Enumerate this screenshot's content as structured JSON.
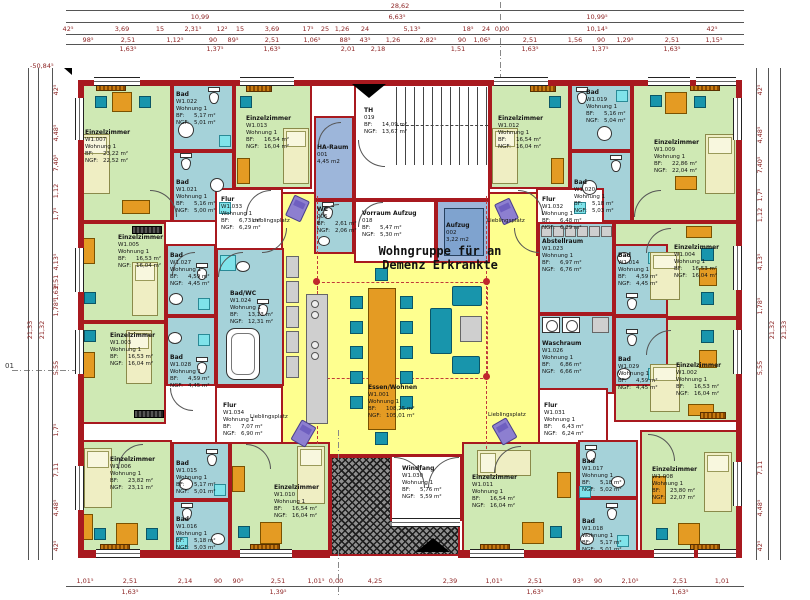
{
  "meta": {
    "title1": "Wohngruppe für an",
    "title2": "Demenz Erkrankte"
  },
  "labels": {
    "bf": "BF:",
    "ngf": "NGF:",
    "lieblingsplatz": "Lieblingsplatz"
  },
  "rooms": {
    "w1001": {
      "name": "Essen/Wohnen",
      "num": "W1.001",
      "apt": "Wohnung 1",
      "bf": "108,25 m²",
      "ngf": "105,01 m²"
    },
    "w1002": {
      "name": "Einzelzimmer",
      "num": "W1.002",
      "apt": "Wohnung 1",
      "bf": "16,53 m²",
      "ngf": "16,04 m²"
    },
    "w1003": {
      "name": "Einzelzimmer",
      "num": "W1.003",
      "apt": "Wohnung 1",
      "bf": "16,53 m²",
      "ngf": "16,04 m²"
    },
    "w1004": {
      "name": "Einzelzimmer",
      "num": "W1.004",
      "apt": "Wohnung 1",
      "bf": "16,53 m²",
      "ngf": "16,04 m²"
    },
    "w1005": {
      "name": "Einzelzimmer",
      "num": "W1.005",
      "apt": "Wohnung 1",
      "bf": "16,53 m²",
      "ngf": "16,04 m²"
    },
    "w1006": {
      "name": "Einzelzimmer",
      "num": "W1.006",
      "apt": "Wohnung 1",
      "bf": "23,82 m²",
      "ngf": "23,11 m²"
    },
    "w1007": {
      "name": "Einzelzimmer",
      "num": "W1.007",
      "apt": "Wohnung 1",
      "bf": "23,22 m²",
      "ngf": "22,52 m²"
    },
    "w1008": {
      "name": "Einzelzimmer",
      "num": "W1.008",
      "apt": "Wohnung 1",
      "bf": "23,80 m²",
      "ngf": "22,07 m²"
    },
    "w1009": {
      "name": "Einzelzimmer",
      "num": "W1.009",
      "apt": "Wohnung 1",
      "bf": "22,86 m²",
      "ngf": "22,04 m²"
    },
    "w1010": {
      "name": "Einzelzimmer",
      "num": "W1.010",
      "apt": "Wohnung 1",
      "bf": "16,54 m²",
      "ngf": "16,04 m²"
    },
    "w1011": {
      "name": "Einzelzimmer",
      "num": "W1.011",
      "apt": "Wohnung 1",
      "bf": "16,54 m²",
      "ngf": "16,04 m²"
    },
    "w1012": {
      "name": "Einzelzimmer",
      "num": "W1.012",
      "apt": "Wohnung 1",
      "bf": "16,54 m²",
      "ngf": "16,04 m²"
    },
    "w1013": {
      "name": "Einzelzimmer",
      "num": "W1.013",
      "apt": "Wohnung 1",
      "bf": "16,54 m²",
      "ngf": "16,04 m²"
    },
    "w1014": {
      "name": "Bad",
      "num": "W1.014",
      "apt": "Wohnung 1",
      "bf": "4,59 m²",
      "ngf": "4,45 m²"
    },
    "w1015": {
      "name": "Bad",
      "num": "W1.015",
      "apt": "Wohnung 1",
      "bf": "5,17 m²",
      "ngf": "5,01 m²"
    },
    "w1016": {
      "name": "Bad",
      "num": "W1.016",
      "apt": "Wohnung 1",
      "bf": "5,18 m²",
      "ngf": "5,03 m²"
    },
    "w1017": {
      "name": "Bad",
      "num": "W1.017",
      "apt": "Wohnung 1",
      "bf": "5,18 m²",
      "ngf": "5,02 m²"
    },
    "w1018": {
      "name": "Bad",
      "num": "W1.018",
      "apt": "Wohnung 1",
      "bf": "5,17 m²",
      "ngf": "5,01 m²"
    },
    "w1019": {
      "name": "Bad",
      "num": "W1.019",
      "apt": "Wohnung 1",
      "bf": "5,16 m²",
      "ngf": "5,04 m²"
    },
    "w1020": {
      "name": "Bad",
      "num": "W1.020",
      "apt": "Wohnung 1",
      "bf": "5,18 m²",
      "ngf": "5,03 m²"
    },
    "w1021": {
      "name": "Bad",
      "num": "W1.021",
      "apt": "Wohnung 1",
      "bf": "5,16 m²",
      "ngf": "5,00 m²"
    },
    "w1022": {
      "name": "Bad",
      "num": "W1.022",
      "apt": "Wohnung 1",
      "bf": "5,17 m²",
      "ngf": "5,01 m²"
    },
    "w1023": {
      "name": "Abstellraum",
      "num": "W1.023",
      "apt": "Wohnung 1",
      "bf": "6,97 m²",
      "ngf": "6,76 m²"
    },
    "w1024": {
      "name": "Bad/WC",
      "num": "W1.024",
      "apt": "Wohnung 1",
      "bf": "13,13 m²",
      "ngf": "12,31 m²"
    },
    "w1026": {
      "name": "Waschraum",
      "num": "W1.026",
      "apt": "Wohnung 1",
      "bf": "6,86 m²",
      "ngf": "6,66 m²"
    },
    "w1027": {
      "name": "Bad",
      "num": "W1.027",
      "apt": "Wohnung 1",
      "bf": "4,59 m²",
      "ngf": "4,45 m²"
    },
    "w1028": {
      "name": "Bad",
      "num": "W1.028",
      "apt": "Wohnung 1",
      "bf": "4,59 m²",
      "ngf": "4,45 m²"
    },
    "w1029": {
      "name": "Bad",
      "num": "W1.029",
      "apt": "Wohnung 1",
      "bf": "4,59 m²",
      "ngf": "4,45 m²"
    },
    "w1030": {
      "name": "Windfang",
      "num": "W1.030",
      "apt": "Wohnung 1",
      "bf": "5,76 m²",
      "ngf": "5,59 m²"
    },
    "w1031": {
      "name": "Flur",
      "num": "W1.031",
      "apt": "Wohnung 1",
      "bf": "6,43 m²",
      "ngf": "6,24 m²"
    },
    "w1032": {
      "name": "Flur",
      "num": "W1.032",
      "apt": "Wohnung 1",
      "bf": "6,48 m²",
      "ngf": "6,29 m²"
    },
    "w1033": {
      "name": "Flur",
      "num": "W1.033",
      "apt": "Wohnung 1",
      "bf": "6,73 m²",
      "ngf": "6,29 m²"
    },
    "w1034": {
      "name": "Flur",
      "num": "W1.034",
      "apt": "Wohnung 1",
      "bf": "7,07 m²",
      "ngf": "6,90 m²"
    },
    "ha": {
      "name": "HA-Raum",
      "num": "001",
      "area": "4,45 m2"
    },
    "aufzug": {
      "name": "Aufzug",
      "num": "002",
      "area": "3,22 m2"
    },
    "wc": {
      "name": "WC",
      "num": "006",
      "bf": "2,61 m²",
      "ngf": "2,06 m²"
    },
    "vorraum": {
      "name": "Vorraum Aufzug",
      "num": "018",
      "bf": "5,47 m²",
      "ngf": "5,30 m²"
    },
    "th": {
      "name": "TH",
      "num": "019",
      "bf": "14,09 m²",
      "ngf": "13,67 m²"
    }
  },
  "dims": {
    "total_top": "28,62",
    "top2": [
      "10,99",
      "6,63⁵",
      "10,99⁵"
    ],
    "top3": [
      "42⁵",
      "3,69",
      "15",
      "2,31⁵",
      "12²",
      "15",
      "3,69",
      "17⁵",
      "25",
      "1,26",
      "24",
      "5,13⁵",
      "18⁵",
      "24",
      "0,00",
      "10,14⁵",
      "42⁵"
    ],
    "top4": [
      "98⁵",
      "2,51",
      "1,12⁵",
      "90",
      "89⁵",
      "2,51",
      "1,06⁵",
      "88⁵",
      "43⁵",
      "1,26",
      "2,82⁵",
      "90",
      "1,06⁵",
      "2,51",
      "1,56",
      "90",
      "1,29⁵",
      "2,51",
      "1,15⁵"
    ],
    "top5": [
      "1,63⁵",
      "1,37⁵",
      "1,63⁵",
      "2,01",
      "2,18",
      "1,51",
      "1,63⁵",
      "1,37⁵",
      "1,63⁵"
    ],
    "bottom1": [
      "1,01⁵",
      "2,51",
      "2,14",
      "90",
      "90⁵",
      "2,51",
      "1,01⁵",
      "0,00",
      "4,25",
      "2,39",
      "1,01⁵",
      "2,51",
      "93⁵",
      "90",
      "2,10⁵",
      "2,51",
      "1,01"
    ],
    "bottom2": [
      "1,63⁵",
      "1,39⁵",
      "1,63⁵",
      "1,63⁵"
    ],
    "left_total1": "21,33",
    "left_total2": "21,32",
    "left": [
      "42⁵",
      "4,48⁵",
      "7,40⁵",
      "1,12",
      "1,7⁵",
      "4,13⁵",
      "2,51",
      "1,63⁵",
      "1,78⁵",
      "5,55",
      "1,7⁵",
      "7,11",
      "4,48⁵",
      "42⁵"
    ],
    "right_total1": "21,33",
    "right_total2": "21,32",
    "right": [
      "42⁵",
      "4,48⁵",
      "7,40⁵",
      "1,7⁵",
      "1,12",
      "4,13⁵",
      "1,78⁵",
      "5,55",
      "7,11",
      "4,48⁵",
      "42⁵"
    ]
  },
  "marks": {
    "level": "-50,84⁵",
    "axis": "01"
  }
}
